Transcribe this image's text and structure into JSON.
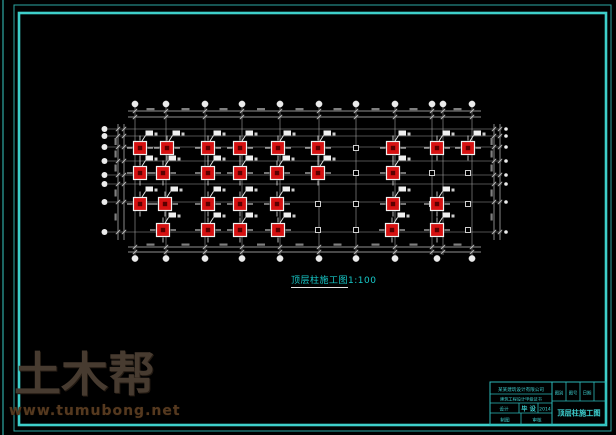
{
  "frame": {
    "color": "#3ecfca",
    "outer_color": "#2da8a4",
    "edge_line_x": 3,
    "outer": [
      14,
      5,
      597,
      426
    ],
    "inner": [
      19,
      13,
      587,
      412
    ]
  },
  "caption": {
    "title": "顶层柱施工图",
    "scale": "1:100"
  },
  "watermark": {
    "brand": "土木帮",
    "url": "www.tumubong.net"
  },
  "title_block": {
    "line_color": "#2cb8b8",
    "text_color": "#3ed2d2",
    "company": "某某建筑设计有限公司",
    "certificate": "建筑工程设计甲级证书",
    "design_label": "设计",
    "project_label": "毕 设",
    "year": "2014",
    "row4_left": "制图",
    "row4_right": "审核",
    "small_cells": [
      "图别",
      "图号",
      "日期",
      ""
    ],
    "drawing_title": "顶层柱施工图"
  },
  "plan": {
    "colors": {
      "grid": "#9f9f9f",
      "dim": "#c2c2c2",
      "bubble": "#ebebeb",
      "column_fill": "#d61111",
      "column_stroke": "#f2f2f2",
      "column_core": "#5a0000",
      "marker": "#e6e6e6",
      "tag": "#f0f0f0",
      "smudge": "#8d8d8d"
    },
    "grid_x": [
      135,
      166,
      205,
      242,
      280,
      319,
      356,
      395,
      432,
      443,
      472
    ],
    "grid_y": [
      129,
      136,
      147,
      161,
      175,
      184,
      202,
      232
    ],
    "grid_top": 107,
    "grid_bottom": 255,
    "grid_left": 108,
    "grid_right": 502,
    "top_bubble_y": 104,
    "bottom_bubble_y": 258.5,
    "bottom_bubble_x": [
      135,
      166,
      205,
      242,
      280,
      319,
      356,
      395,
      437,
      472
    ],
    "left_bubble_x": 104.5,
    "right_dot_x": 506,
    "dim_top_y": [
      111,
      117
    ],
    "dim_bottom_y": [
      247,
      252
    ],
    "dim_left_x": [
      118,
      124
    ],
    "dim_right_x": [
      494,
      500
    ],
    "dim_span_x": [
      128,
      481
    ],
    "dim_span_y": [
      124,
      240
    ],
    "columns": [
      [
        140,
        148
      ],
      [
        167,
        148
      ],
      [
        208,
        148
      ],
      [
        240,
        148
      ],
      [
        278,
        148
      ],
      [
        318,
        148
      ],
      [
        393,
        148
      ],
      [
        437,
        148
      ],
      [
        468,
        148
      ],
      [
        140,
        173
      ],
      [
        163,
        173
      ],
      [
        208,
        173
      ],
      [
        240,
        173
      ],
      [
        277,
        173
      ],
      [
        318,
        173
      ],
      [
        393,
        173
      ],
      [
        140,
        204
      ],
      [
        165,
        204
      ],
      [
        208,
        204
      ],
      [
        240,
        204
      ],
      [
        277,
        204
      ],
      [
        393,
        204
      ],
      [
        437,
        204
      ],
      [
        163,
        230
      ],
      [
        208,
        230
      ],
      [
        240,
        230
      ],
      [
        278,
        230
      ],
      [
        392,
        230
      ],
      [
        437,
        230
      ]
    ],
    "markers": [
      [
        356,
        148
      ],
      [
        356,
        173
      ],
      [
        356,
        204
      ],
      [
        356,
        230
      ],
      [
        432,
        173
      ],
      [
        432,
        204
      ],
      [
        468,
        173
      ],
      [
        468,
        204
      ],
      [
        468,
        230
      ],
      [
        318,
        204
      ],
      [
        318,
        230
      ]
    ]
  }
}
